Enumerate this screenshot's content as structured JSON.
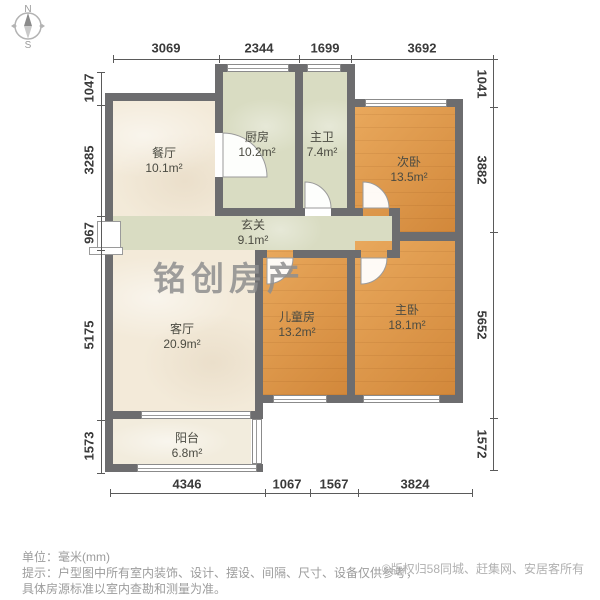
{
  "compass": {
    "north_label": "N",
    "south_label": "S"
  },
  "dimensions": {
    "top": [
      "3069",
      "2344",
      "1699",
      "3692"
    ],
    "left": [
      "1047",
      "3285",
      "967",
      "5175",
      "1573"
    ],
    "right": [
      "1041",
      "3882",
      "5652",
      "1572"
    ],
    "bottom": [
      "4346",
      "1067",
      "1567",
      "3824"
    ]
  },
  "rooms": {
    "dining": {
      "name": "餐厅",
      "area": "10.1m²"
    },
    "kitchen": {
      "name": "厨房",
      "area": "10.2m²"
    },
    "bath": {
      "name": "主卫",
      "area": "7.4m²"
    },
    "bedroom2": {
      "name": "次卧",
      "area": "13.5m²"
    },
    "hall": {
      "name": "玄关",
      "area": "9.1m²"
    },
    "living": {
      "name": "客厅",
      "area": "20.9m²"
    },
    "child": {
      "name": "儿童房",
      "area": "13.2m²"
    },
    "master": {
      "name": "主卧",
      "area": "18.1m²"
    },
    "balcony": {
      "name": "阳台",
      "area": "6.8m²"
    }
  },
  "watermark": "铭创房产",
  "footer": {
    "unit_line": "单位：毫米(mm)",
    "tip_line1": "提示：户型图中所有室内装饰、设计、摆设、间隔、尺寸、设备仅供参考，",
    "tip_line2": "具体房源标准以室内查勘和测量为准。",
    "copyright": "©版权归58同城、赶集网、安居客所有"
  },
  "colors": {
    "wall": "#6d6d6f",
    "room_cream": "#f3ead9",
    "room_green": "#d9dcc2",
    "room_wood": "#dd9243",
    "watermark_gray": "#8f8f8f"
  }
}
